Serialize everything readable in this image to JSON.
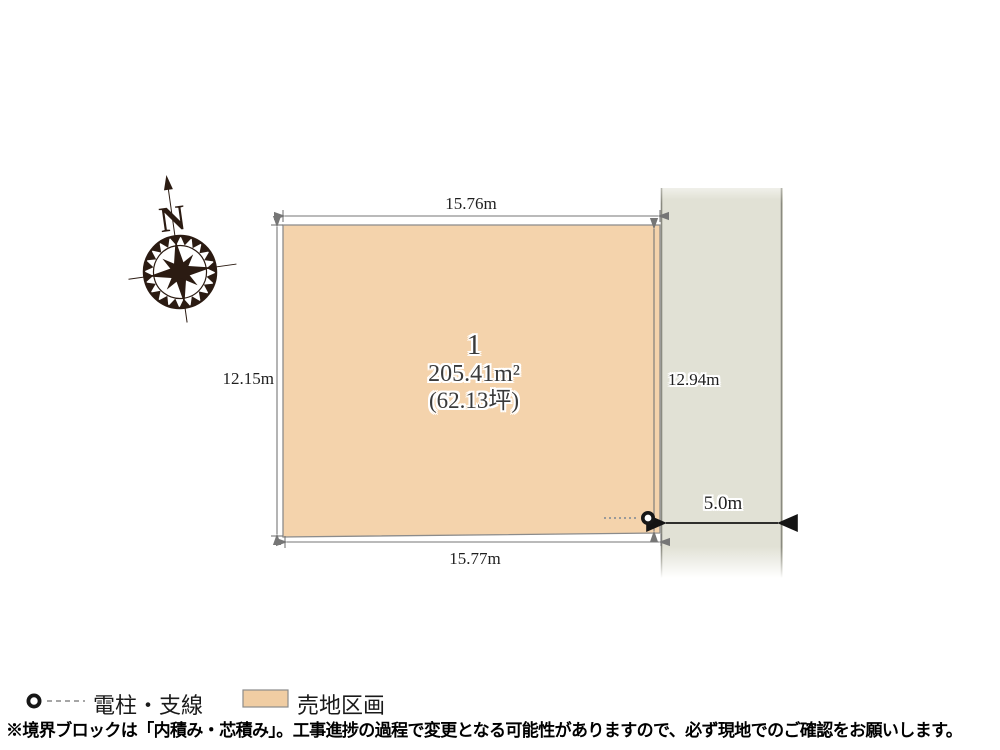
{
  "compass": {
    "label": "N"
  },
  "lot": {
    "number": "1",
    "area_m2": "205.41m²",
    "area_tsubo": "(62.13坪)",
    "fill": "#f4d3ac"
  },
  "dimensions": {
    "top": "15.76m",
    "bottom": "15.77m",
    "left": "12.15m",
    "right": "12.94m",
    "road_width": "5.0m"
  },
  "road": {
    "fill": "#e1e1d5"
  },
  "legend": {
    "pole_label": "電柱・支線",
    "lot_label": "売地区画",
    "lot_swatch": "#f0cda3"
  },
  "footnote": "※境界ブロックは「内積み・芯積み」。工事進捗の過程で変更となる可能性がありますので、必ず現地でのご確認をお願いします。"
}
